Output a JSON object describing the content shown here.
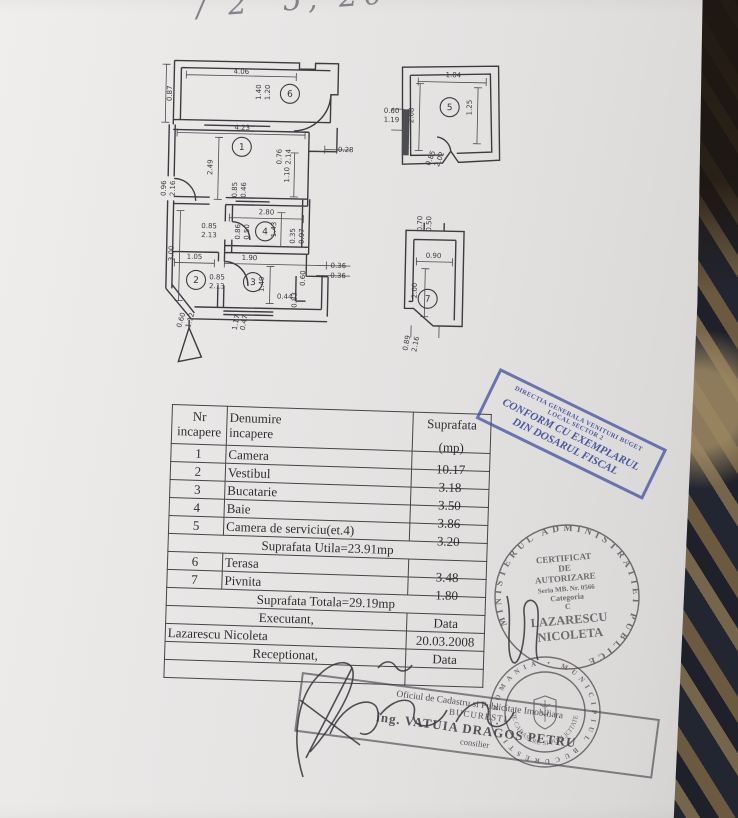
{
  "handwriting_top": "/ 2' 5, 20",
  "floor_plan": {
    "rooms": [
      {
        "n": "1",
        "x": 243,
        "y": 147
      },
      {
        "n": "2",
        "x": 200,
        "y": 281
      },
      {
        "n": "3",
        "x": 257,
        "y": 282
      },
      {
        "n": "4",
        "x": 268,
        "y": 231
      },
      {
        "n": "5",
        "x": 450,
        "y": 103
      },
      {
        "n": "6",
        "x": 290,
        "y": 93
      },
      {
        "n": "7",
        "x": 432,
        "y": 295
      }
    ],
    "dim_labels": [
      {
        "t": "4.06",
        "x": 241,
        "y": 74,
        "r": 0
      },
      {
        "t": "0.87",
        "x": 172,
        "y": 95,
        "r": -90
      },
      {
        "t": "1.40",
        "x": 261,
        "y": 92,
        "r": -90
      },
      {
        "t": "1.20",
        "x": 270,
        "y": 92,
        "r": -90
      },
      {
        "t": "0.76",
        "x": 283,
        "y": 156,
        "r": -90
      },
      {
        "t": "2.14",
        "x": 292,
        "y": 156,
        "r": -90
      },
      {
        "t": "4.23",
        "x": 243,
        "y": 130,
        "r": 0
      },
      {
        "t": "2.49",
        "x": 214,
        "y": 168,
        "r": -90
      },
      {
        "t": "0.28",
        "x": 347,
        "y": 150,
        "r": 0
      },
      {
        "t": "1.10",
        "x": 291,
        "y": 174,
        "r": -90
      },
      {
        "t": "0.96",
        "x": 168,
        "y": 190,
        "r": -90
      },
      {
        "t": "2.16",
        "x": 177,
        "y": 190,
        "r": -90
      },
      {
        "t": "0.85",
        "x": 239,
        "y": 190,
        "r": -90
      },
      {
        "t": "0.46",
        "x": 248,
        "y": 190,
        "r": -90
      },
      {
        "t": "2.80",
        "x": 269,
        "y": 214,
        "r": 0
      },
      {
        "t": "0.85",
        "x": 212,
        "y": 229,
        "r": 0
      },
      {
        "t": "2.13",
        "x": 212,
        "y": 238,
        "r": 0
      },
      {
        "t": "0.86",
        "x": 243,
        "y": 232,
        "r": -90
      },
      {
        "t": "0.50",
        "x": 252,
        "y": 232,
        "r": -90
      },
      {
        "t": "1.43",
        "x": 279,
        "y": 229,
        "r": -90
      },
      {
        "t": "0.35",
        "x": 298,
        "y": 235,
        "r": -90
      },
      {
        "t": "0.97",
        "x": 307,
        "y": 235,
        "r": -90
      },
      {
        "t": "3.00",
        "x": 177,
        "y": 255,
        "r": -90
      },
      {
        "t": "1.05",
        "x": 198,
        "y": 260,
        "r": 0
      },
      {
        "t": "1.90",
        "x": 253,
        "y": 260,
        "r": 0
      },
      {
        "t": "0.85",
        "x": 221,
        "y": 280,
        "r": 0
      },
      {
        "t": "2.13",
        "x": 221,
        "y": 289,
        "r": 0
      },
      {
        "t": "1.49",
        "x": 268,
        "y": 284,
        "r": -90
      },
      {
        "t": "0.36",
        "x": 342,
        "y": 266,
        "r": 0
      },
      {
        "t": "0.36",
        "x": 342,
        "y": 276,
        "r": 0
      },
      {
        "t": "0.60",
        "x": 309,
        "y": 277,
        "r": -90
      },
      {
        "t": "0.44",
        "x": 289,
        "y": 298,
        "r": 0
      },
      {
        "t": "0.83",
        "x": 301,
        "y": 299,
        "r": -90
      },
      {
        "t": "0.60",
        "x": 188,
        "y": 322,
        "r": -75
      },
      {
        "t": "1.12",
        "x": 197,
        "y": 322,
        "r": -75
      },
      {
        "t": "1.17",
        "x": 243,
        "y": 323,
        "r": -80
      },
      {
        "t": "0.47",
        "x": 251,
        "y": 323,
        "r": -80
      },
      {
        "t": "1.84",
        "x": 453,
        "y": 73,
        "r": 0
      },
      {
        "t": "1.25",
        "x": 472,
        "y": 103,
        "r": -90
      },
      {
        "t": "2.08",
        "x": 414,
        "y": 112,
        "r": -90
      },
      {
        "t": "0.60",
        "x": 392,
        "y": 110,
        "r": 0
      },
      {
        "t": "1.19",
        "x": 392,
        "y": 119,
        "r": 0
      },
      {
        "t": "0.85",
        "x": 434,
        "y": 155,
        "r": -70
      },
      {
        "t": "2.02",
        "x": 443,
        "y": 156,
        "r": -70
      },
      {
        "t": "0.70",
        "x": 425,
        "y": 220,
        "r": -90
      },
      {
        "t": "0.50",
        "x": 434,
        "y": 220,
        "r": -90
      },
      {
        "t": "0.90",
        "x": 437,
        "y": 254,
        "r": 0
      },
      {
        "t": "2.00",
        "x": 421,
        "y": 287,
        "r": -90
      },
      {
        "t": "0.89",
        "x": 414,
        "y": 340,
        "r": -80
      },
      {
        "t": "2.16",
        "x": 423,
        "y": 341,
        "r": -80
      }
    ]
  },
  "table": {
    "header": {
      "c1a": "Nr",
      "c1b": "incapere",
      "c2a": "Denumire",
      "c2b": "incapere",
      "c3a": "Suprafata",
      "c3b": "(mp)"
    },
    "rows": [
      {
        "nr": "1",
        "name": "Camera",
        "area": "10.17"
      },
      {
        "nr": "2",
        "name": "Vestibul",
        "area": "3.18"
      },
      {
        "nr": "3",
        "name": "Bucatarie",
        "area": "3.50"
      },
      {
        "nr": "4",
        "name": "Baie",
        "area": "3.86"
      },
      {
        "nr": "5",
        "name": "Camera de serviciu(et.4)",
        "area": "3.20"
      }
    ],
    "utila": "Suprafata Utila=23.91mp",
    "rows2": [
      {
        "nr": "6",
        "name": "Terasa",
        "area": "3.48"
      },
      {
        "nr": "7",
        "name": "Pivnita",
        "area": "1.80"
      }
    ],
    "totala": "Suprafata Totala=29.19mp",
    "executant_label": "Executant,",
    "data_label": "Data",
    "executant_name": "Lazarescu Nicoleta",
    "date_value": "20.03.2008",
    "receptionat_label": "Receptionat,",
    "data_label2": "Data"
  },
  "stamps": {
    "blue": {
      "l1": "DIRECTIA GENERALA VENITURI BUGET",
      "l2": "LOCAL SECTOR 2",
      "l3": "CONFORM CU EXEMPLARUL",
      "l4": "DIN DOSARUL FISCAL",
      "color": "#3e4ca0"
    },
    "round1": {
      "ring": "MINISTERUL ADMINISTRATIEI PUBLICE",
      "center": [
        "CERTIFICAT",
        "DE",
        "AUTORIZARE",
        "Seria MB. Nr. 0566",
        "Categoria",
        "C",
        "LAZARESCU",
        "NICOLETA"
      ]
    },
    "round2": {
      "ring": "• ROMANIA •  MUNICIPIUL BUCURESTI",
      "inner": "DE CADASTRU SI PUBLICITATE"
    },
    "rect": {
      "l1": "Oficiul de Cadastru si Publicitate Imobiliara",
      "l2": "BUCURESTI",
      "l3": "ing. VATUIA DRAGOS PETRU",
      "l4": "consilier"
    }
  }
}
